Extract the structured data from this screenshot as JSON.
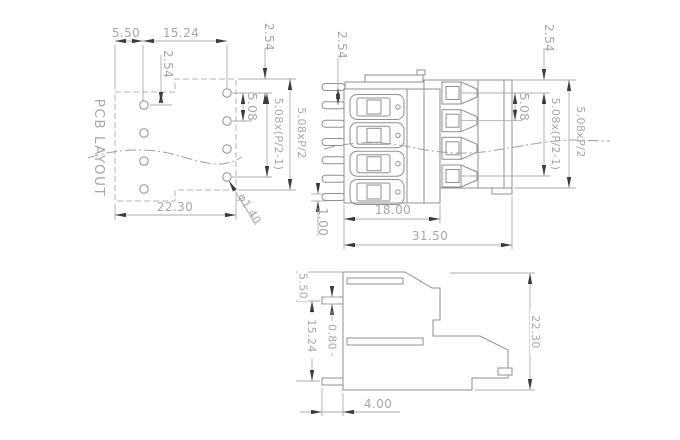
{
  "drawing_title": "PCB LAYOUT",
  "pcb_view": {
    "label": "PCB LAYOUT",
    "dim_edge_to_hole": "5.50",
    "dim_row_spacing": "15.24",
    "dim_stagger_left": "2.54",
    "dim_stagger_right": "2.54",
    "dim_hole_pitch": "5.08",
    "dim_span_holes": "5.08x(P/2-1)",
    "dim_span_total": "5.08xP/2",
    "dim_width": "22.30",
    "dim_hole_dia": "φ1.40"
  },
  "front_view": {
    "dim_pin_stagger": "2.54",
    "dim_top_offset": "2.54",
    "dim_pole_pitch": "5.08",
    "dim_span_poles": "5.08x(P/2-1)",
    "dim_span_total": "5.08xP/2",
    "dim_pin_thickness": "1.00",
    "dim_body_width": "18.00",
    "dim_total_width": "31.50"
  },
  "side_view": {
    "dim_top_to_pin": "5.50",
    "dim_pin_spacing": "15.24",
    "dim_pin_thickness": "0.80",
    "dim_height": "22.30",
    "dim_pin_length": "4.00"
  },
  "colors": {
    "background": "#ffffff",
    "object_line": "#8f8f8f",
    "dashed_line": "#b5b5b5",
    "dimension_line": "#ababab",
    "arrow": "#3c3c3c",
    "text": "#a6a6a6"
  }
}
